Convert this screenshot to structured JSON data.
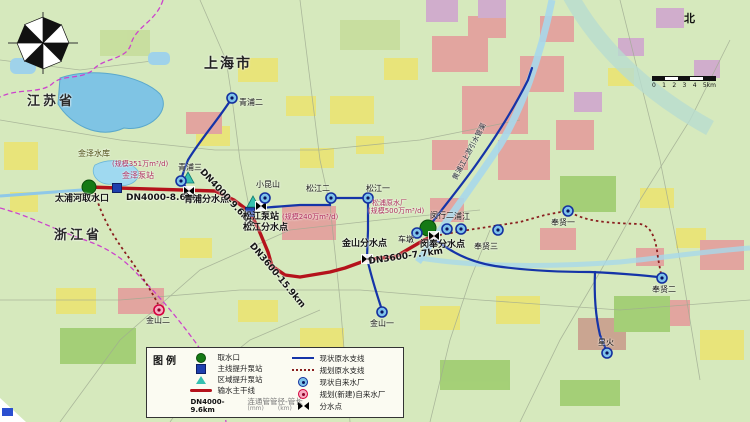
{
  "regions": {
    "jiangsu": "江苏省",
    "zhejiang": "浙江省",
    "shanghai": "上海市"
  },
  "labels": {
    "qingpu2": "青浦二",
    "qingpu3": "青浦三",
    "jinze_reservoir": "金泽水库",
    "jinze_scale": "(规模351万m³/d)",
    "jinze_station": "金泽泵站",
    "taipu_intake": "太浦河取水口",
    "dn4000_86": "DN4000-8.6km",
    "dn4000_96": "DN4000-9.6km",
    "qingpu_junction": "青浦分水点",
    "xiaokunshan": "小昆山",
    "songjiang_station": "松江泵站",
    "songjiang_scale": "(规模240万m³/d)",
    "songjiang_junction": "松江分水点",
    "songjiang2": "松江二",
    "songjiang1": "松江一",
    "dn3600_159": "DN3600-15.9km",
    "jinshan_junction": "金山分水点",
    "songpu_plant": "松浦原水厂",
    "songpu_scale": "(规模500万m³/d)",
    "chedun": "车墩",
    "minhang2": "闵行二",
    "pujiang": "浦江",
    "minfeng_junction": "闵奉分水点",
    "dn3600_77": "DN3600-7.7km",
    "huangpu_channel": "黄浦江上游引水管渠",
    "fengxian1": "奉贤一",
    "fengxian2": "奉贤二",
    "fengxian3": "奉贤三",
    "xinghuo": "星火",
    "jinshan1": "金山一",
    "jinshan2": "金山二"
  },
  "legend": {
    "title": "图例",
    "items_left": [
      {
        "icon": "intake-circle",
        "label": "取水口"
      },
      {
        "icon": "main-pump-square",
        "label": "主线提升泵站"
      },
      {
        "icon": "regional-pump-triangle",
        "label": "区域提升泵站"
      },
      {
        "icon": "main-line",
        "label": "输水主干线"
      },
      {
        "icon": "dn-sample",
        "sample": "DN4000-9.6km",
        "label": "连通管管径-管长",
        "sub_mm": "(mm)",
        "sub_km": "(km)"
      }
    ],
    "items_right": [
      {
        "icon": "existing-branch-line",
        "label": "现状原水支线"
      },
      {
        "icon": "planned-branch-line",
        "label": "规划原水支线"
      },
      {
        "icon": "existing-waterworks-ring",
        "label": "现状自来水厂"
      },
      {
        "icon": "planned-waterworks-ring",
        "label": "规划(新建)自来水厂"
      },
      {
        "icon": "junction-bowtie",
        "label": "分水点"
      }
    ]
  },
  "compass": {
    "north": "北"
  },
  "scalebar": {
    "ticks": [
      "0",
      "1",
      "2",
      "3",
      "4",
      "5km"
    ]
  },
  "colors": {
    "main_line": "#b5121b",
    "branch_line": "#1534a8",
    "planned_line": "#8a1f1f",
    "province_boundary": "#cc44cc",
    "intake_marker": "#157a15",
    "pump_marker": "#1e3fae",
    "regional_pump_marker": "#35c0b0",
    "existing_plant_ring": "#14309e",
    "planned_plant_ring": "#d4003c",
    "water": "#7fc4e4",
    "land": "#d6e9bd"
  }
}
